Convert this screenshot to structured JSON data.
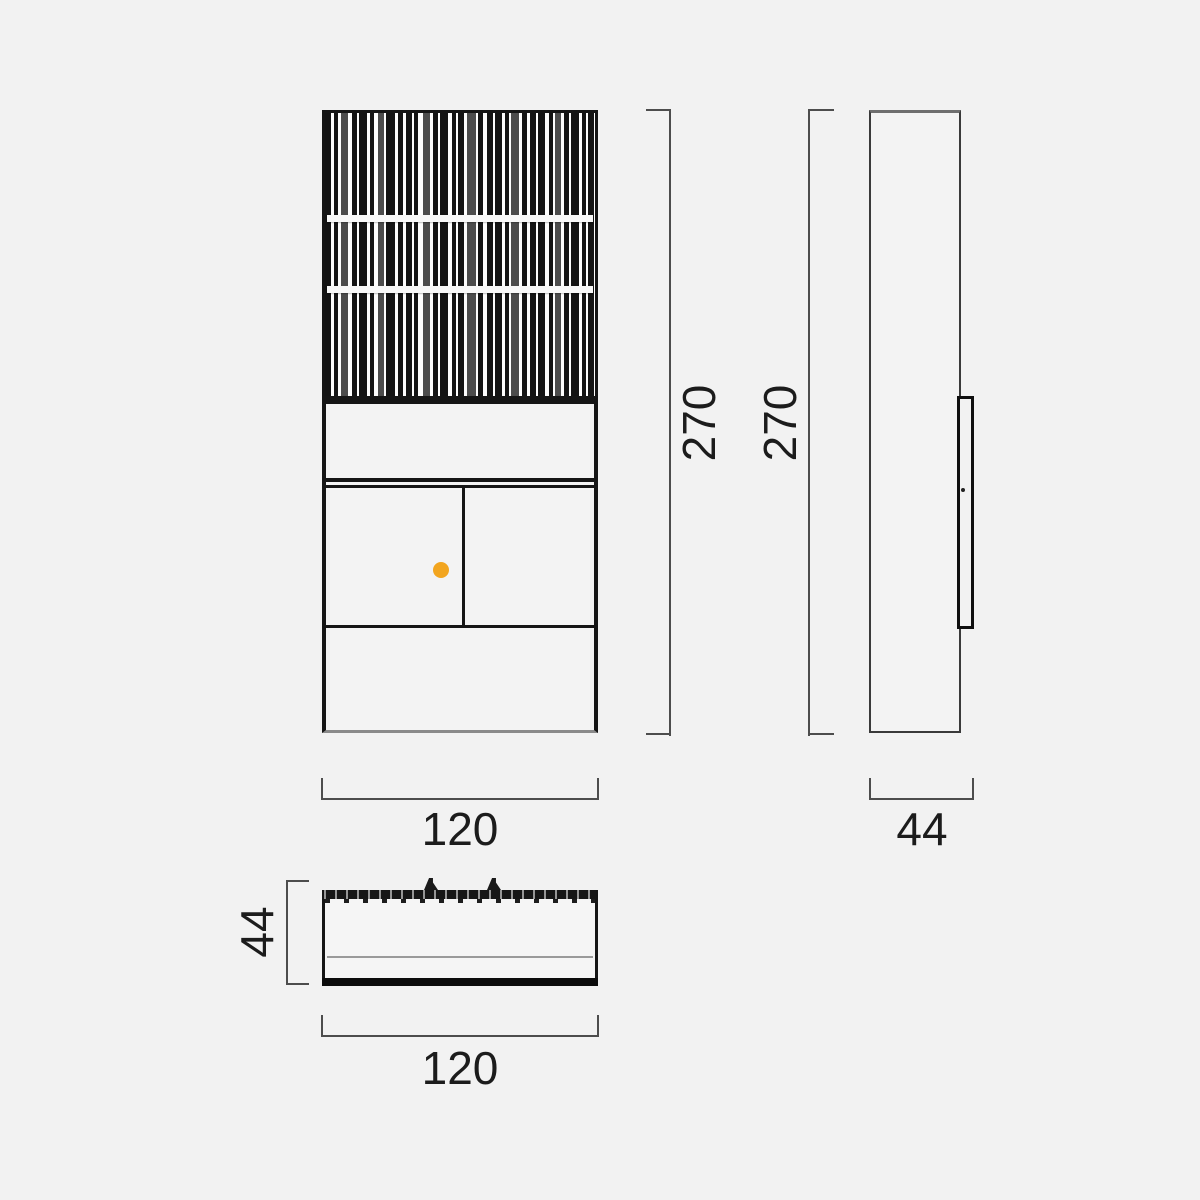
{
  "labels": {
    "front_height": "270",
    "side_height": "270",
    "front_width": "120",
    "side_depth": "44",
    "top_depth": "44",
    "top_width": "120"
  },
  "colors": {
    "background": "#F2F2F2",
    "line_dark": "#151515",
    "line_dim": "#4D4D4D",
    "accent_dot": "#F2A51F"
  },
  "grille": {
    "bars": [
      [
        6,
        3,
        0
      ],
      [
        4,
        3,
        0
      ],
      [
        7,
        4,
        1
      ],
      [
        5,
        2,
        0
      ],
      [
        8,
        3,
        0
      ],
      [
        4,
        4,
        0
      ],
      [
        6,
        2,
        1
      ],
      [
        9,
        3,
        0
      ],
      [
        5,
        3,
        0
      ],
      [
        6,
        2,
        0
      ],
      [
        4,
        5,
        0
      ],
      [
        7,
        3,
        1
      ],
      [
        5,
        2,
        0
      ],
      [
        8,
        4,
        0
      ],
      [
        4,
        2,
        0
      ],
      [
        6,
        3,
        0
      ],
      [
        9,
        2,
        1
      ],
      [
        5,
        4,
        0
      ],
      [
        6,
        2,
        0
      ],
      [
        7,
        3,
        0
      ],
      [
        4,
        2,
        0
      ],
      [
        8,
        3,
        1
      ],
      [
        5,
        3,
        0
      ],
      [
        6,
        2,
        0
      ],
      [
        7,
        4,
        0
      ],
      [
        4,
        2,
        0
      ],
      [
        6,
        3,
        1
      ],
      [
        5,
        2,
        0
      ],
      [
        8,
        3,
        0
      ],
      [
        4,
        2,
        0
      ],
      [
        6,
        0,
        0
      ]
    ]
  }
}
